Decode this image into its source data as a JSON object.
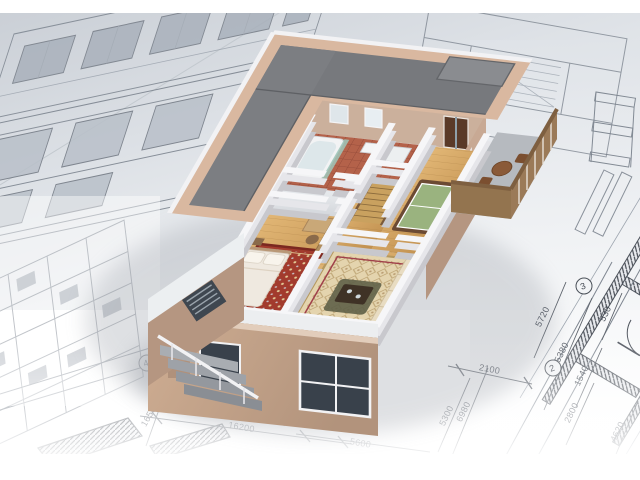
{
  "scene": {
    "description": "3D cutaway model of a two-storey house standing on architectural blueprint drawings",
    "type": "architectural-visualization"
  },
  "blueprint": {
    "dimensions": [
      "16200",
      "12400",
      "5600",
      "2300",
      "1650",
      "2100",
      "5300",
      "6980",
      "5720",
      "15380",
      "530",
      "1540",
      "2800",
      "4620"
    ],
    "grid_bubbles": [
      "2",
      "3",
      "4"
    ]
  },
  "palette": {
    "sheet_gray": "#d3d7dc",
    "line_gray": "#6f7680",
    "roof_gray": "#77797d",
    "wall_tan": "#c8a88f",
    "parapet_tan": "#d9b8a0",
    "cut_wall_white": "#f4f4f6",
    "wood_floor": "#d2a362",
    "bedroom_rug_red": "#a23b2d",
    "living_rug_beige": "#e4d4ae",
    "sofa_cream": "#e8dcc2",
    "bathroom_tile": "#b4624a",
    "games_table_green": "#9ab37f",
    "window_glass": "#39414b"
  }
}
